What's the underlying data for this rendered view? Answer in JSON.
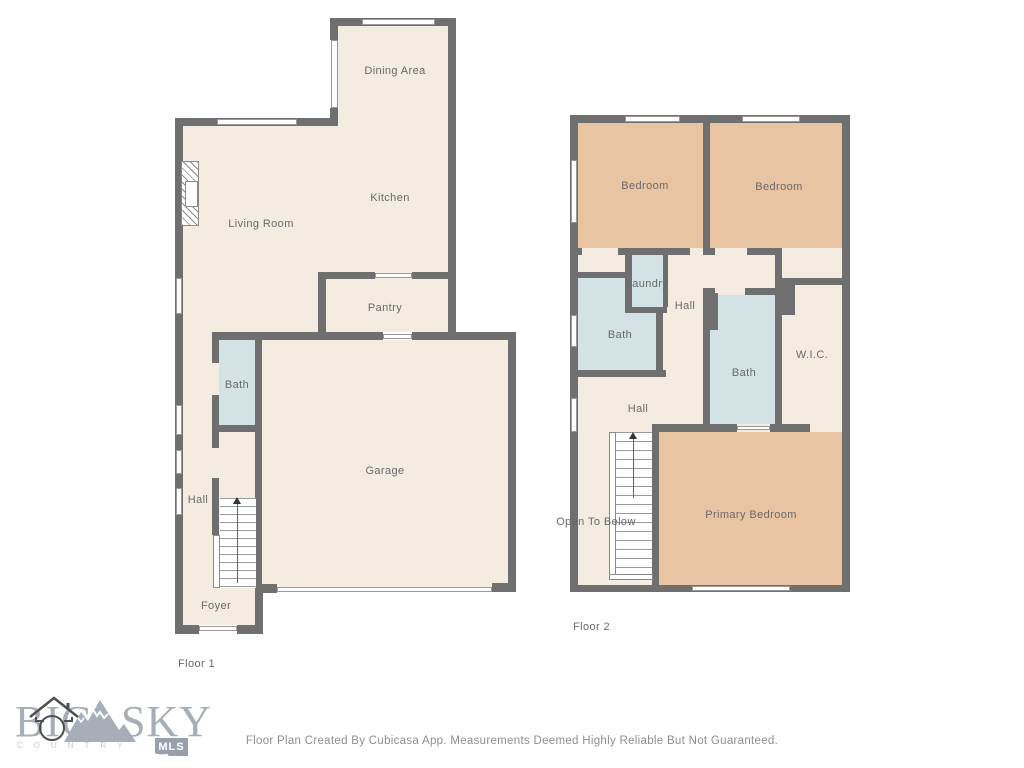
{
  "floor1": {
    "name": "Floor 1",
    "rooms": {
      "dining_area": "Dining Area",
      "kitchen": "Kitchen",
      "living_room": "Living Room",
      "pantry": "Pantry",
      "bath": "Bath",
      "garage": "Garage",
      "hall": "Hall",
      "foyer": "Foyer"
    }
  },
  "floor2": {
    "name": "Floor 2",
    "rooms": {
      "bedroom_left": "Bedroom",
      "bedroom_right": "Bedroom",
      "laundry": "Laundry",
      "hall_upper": "Hall",
      "bath_left": "Bath",
      "bath_center": "Bath",
      "wic": "W.I.C.",
      "hall_lower": "Hall",
      "open_to_below": "Open To Below",
      "primary_bedroom": "Primary Bedroom"
    }
  },
  "branding": {
    "big": "BIG",
    "sky": "SKY",
    "country": "COUNTRY",
    "mls": "MLS"
  },
  "footer": {
    "disclaimer": "Floor Plan Created By Cubicasa App. Measurements Deemed Highly Reliable But Not Guaranteed."
  },
  "colors": {
    "floor": "#f4ece1",
    "bedroom": "#e9c4a3",
    "bath": "#d3e3e5",
    "wall": "#6f6f6f",
    "label_text": "#696969",
    "caption": "#8e8e8e",
    "logo": "#a7aeba",
    "logo_light": "#c6cad3",
    "badge": "#99a0ac"
  }
}
